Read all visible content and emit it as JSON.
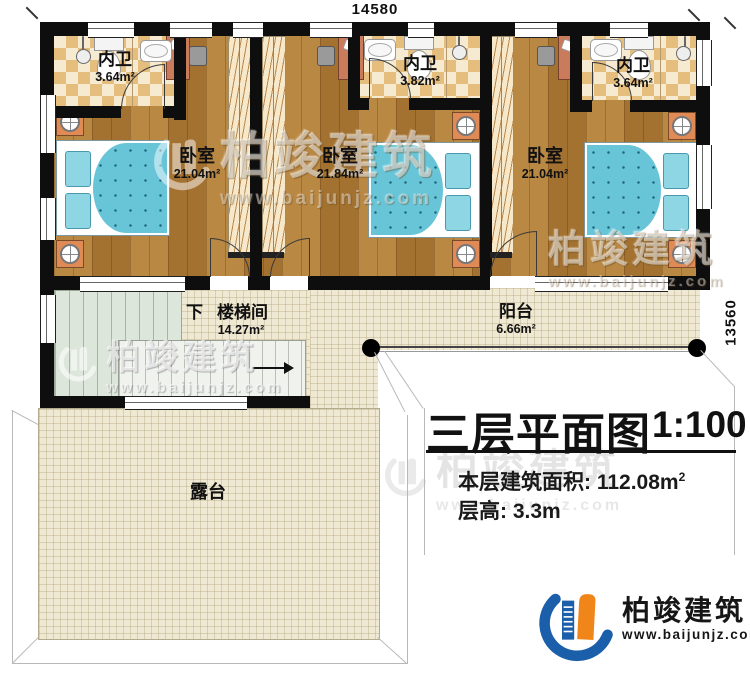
{
  "dimensions": {
    "top": "14580",
    "right": "13560"
  },
  "rooms": {
    "bath1": {
      "name": "内卫",
      "area": "3.64m²"
    },
    "bath2": {
      "name": "内卫",
      "area": "3.82m²"
    },
    "bath3": {
      "name": "内卫",
      "area": "3.64m²"
    },
    "bed1": {
      "name": "卧室",
      "area": "21.04m²"
    },
    "bed2": {
      "name": "卧室",
      "area": "21.84m²"
    },
    "bed3": {
      "name": "卧室",
      "area": "21.04m²"
    },
    "stair": {
      "direction": "下",
      "name": "楼梯间",
      "area": "14.27m²"
    },
    "balcony": {
      "name": "阳台",
      "area": "6.66m²"
    },
    "terrace": {
      "name": "露台"
    }
  },
  "title_block": {
    "title": "三层平面图",
    "scale": "1:100",
    "area_label": "本层建筑面积:",
    "area_value": "112.08m",
    "area_sup": "2",
    "height_label": "层高:",
    "height_value": "3.3m"
  },
  "watermark": {
    "company": "柏竣建筑",
    "website": "www.baijunjz.com"
  },
  "logo": {
    "company": "柏竣建筑",
    "website": "www.baijunjz.com"
  },
  "colors": {
    "wall": "#0e0e0e",
    "wood_floor": "#b17d36",
    "bathroom_tile": "#e5bd7d",
    "bed_blue": "#68c5d8",
    "stair_green": "#dde6da",
    "paving": "#efe8d2",
    "brand_blue": "#1b5ea9",
    "brand_orange": "#f08519"
  }
}
